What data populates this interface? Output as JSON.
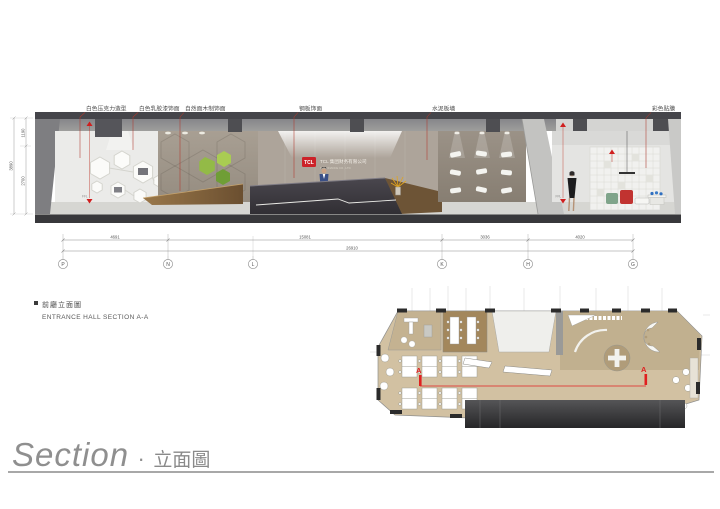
{
  "footer": {
    "title_en": "Section",
    "separator": "·",
    "title_zh": "立面圖"
  },
  "note": {
    "zh": "前廳立面圖",
    "en": "ENTRANCE HALL SECTION A-A"
  },
  "section": {
    "materials": [
      {
        "text": "白色压克力造型"
      },
      {
        "text": "白色乳胶漆饰面"
      },
      {
        "text": "自然面木制饰面"
      },
      {
        "text": "钢板饰面"
      },
      {
        "text": "水泥板墙"
      },
      {
        "text": "彩色贴膜"
      }
    ],
    "signage": {
      "logo": "TCL",
      "name_zh": "TCL 集团财务有限公司",
      "name_en": "TCL FINANCE CO., LTD"
    },
    "level_markers": {
      "ffl_left": "FFL",
      "ffl_right": "FFL"
    }
  },
  "dimensions": {
    "horizontal_segments": [
      "4691",
      "15081",
      "3036",
      "4020"
    ],
    "horizontal_total": "26910",
    "vertical_segments": [
      "1190",
      "2700"
    ],
    "vertical_total": "3890",
    "grid_bubbles": [
      "P",
      "N",
      "L",
      "K",
      "H",
      "G"
    ]
  },
  "plan": {
    "marker_left": "A",
    "marker_right": "A"
  },
  "colors": {
    "accent_red": "#cc2229",
    "leader_red": "#b03a2e",
    "section_line_red": "#e02020",
    "concrete": "#a1988c",
    "wood": "#8a6a44",
    "plan_floor": "#d3c2a3"
  }
}
